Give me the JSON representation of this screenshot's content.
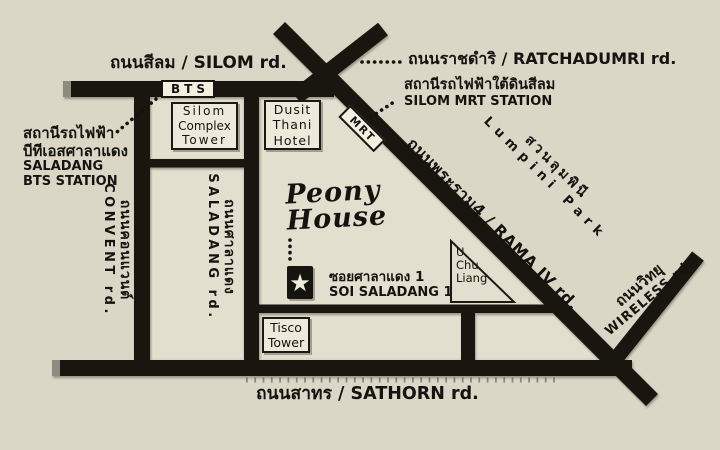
{
  "map": {
    "colors": {
      "background": "#DAD7C7",
      "road": "#18160F",
      "panel": "#E2DFCF",
      "box_fill": "#EDEADC",
      "text": "#14130f"
    },
    "roads": {
      "silom": {
        "label": "ถนนสีลม / SILOM rd."
      },
      "ratchadumri": {
        "label": "ถนนราชดำริ / RATCHADUMRI rd."
      },
      "rama4": {
        "label": "ถนนพระราม4 / RAMA IV rd."
      },
      "sathorn": {
        "label": "ถนนสาทร / SATHORN rd."
      },
      "convent": {
        "thai": "ถนนคอนแวนต์",
        "english": "CONVENT rd."
      },
      "saladang": {
        "thai": "ถนนศาลาแดง",
        "english": "SALADANG rd."
      },
      "wireless": {
        "thai": "ถนนวิทยุ",
        "english": "WIRELESS rd."
      },
      "soi_saladang1": {
        "thai": "ซอยศาลาแดง  1",
        "english": "SOI SALADANG 1"
      }
    },
    "stations": {
      "bts_badge": "BTS",
      "mrt_badge": "MRT",
      "saladang_bts": {
        "thai1": "สถานีรถไฟฟ้า",
        "thai2": "บีทีเอสศาลาแดง",
        "en1": "SALADANG",
        "en2": "BTS STATION"
      },
      "silom_mrt": {
        "thai": "สถานีรถไฟฟ้าใต้ดินสีลม",
        "english": "SILOM MRT STATION"
      }
    },
    "buildings": {
      "silom_complex": {
        "line1": "Silom",
        "line2": "Complex",
        "line3": "Tower"
      },
      "dusit_thani": {
        "line1": "Dusit",
        "line2": "Thani",
        "line3": "Hotel"
      },
      "tisco": {
        "line1": "Tisco",
        "line2": "Tower"
      },
      "u_chu_liang": {
        "line1": "U",
        "line2": "Chu",
        "line3": "Liang"
      }
    },
    "park": {
      "thai": "สวนลุมพินี",
      "english": "Lumpini Park"
    },
    "destination": {
      "line1": "Peony",
      "line2": "House",
      "marker": "★"
    }
  }
}
